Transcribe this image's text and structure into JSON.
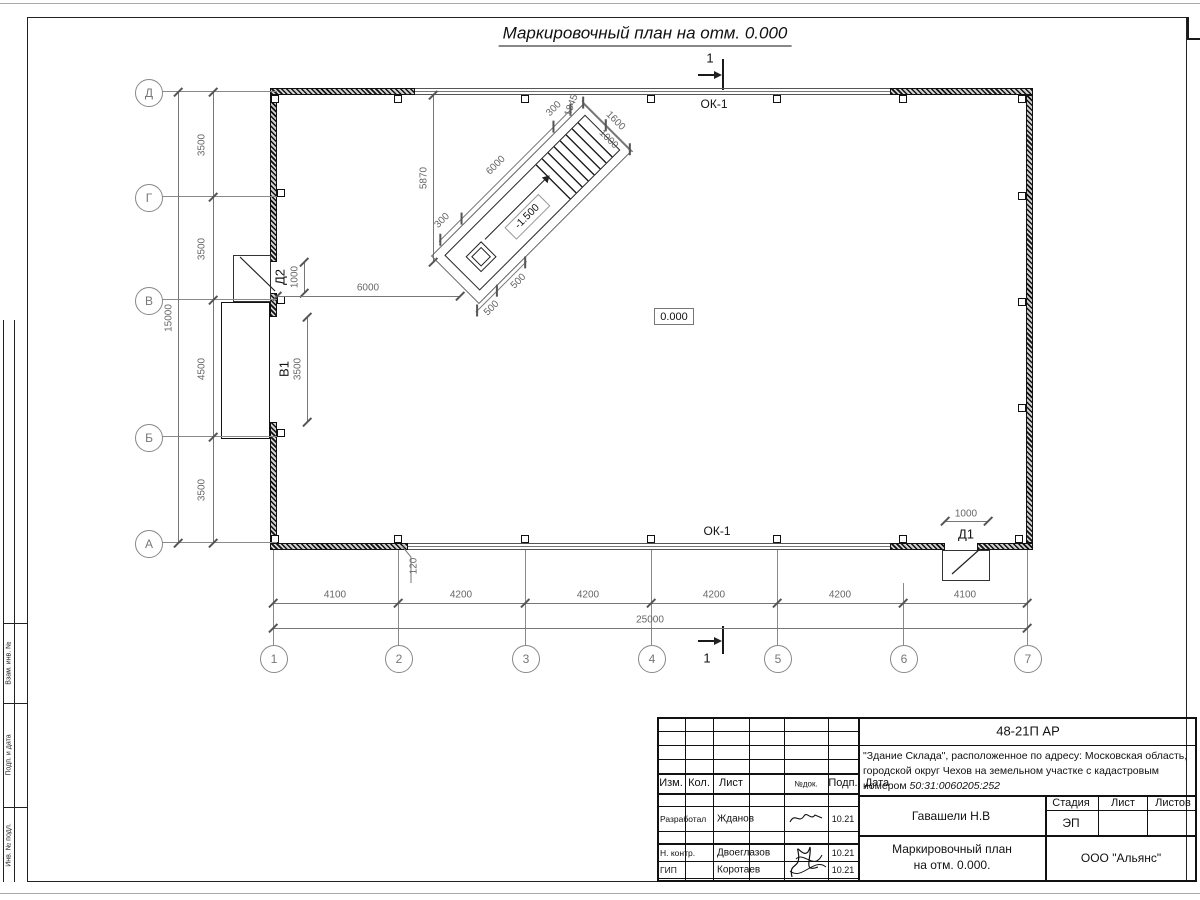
{
  "sheet": {
    "title": "Маркировочный план на отм. 0.000"
  },
  "plan": {
    "section_label_top": "1",
    "section_label_bottom": "1",
    "ok_label_top": "ОК-1",
    "ok_label_bottom": "ОК-1",
    "level_zero": "0.000",
    "row_axes": [
      "Д",
      "Г",
      "В",
      "Б",
      "А"
    ],
    "col_axes": [
      "1",
      "2",
      "3",
      "4",
      "5",
      "6",
      "7"
    ],
    "left_dims": [
      "3500",
      "3500",
      "4500",
      "3500"
    ],
    "left_total": "15000",
    "bottom_dims": [
      "4100",
      "4200",
      "4200",
      "4200",
      "4200",
      "4100"
    ],
    "bottom_total": "25000",
    "wall_offset_dim": "120",
    "stair_wall_dim": "6000",
    "stair_height_dim": "5870",
    "doors": {
      "d1": "Д1",
      "d1_dim": "1000",
      "d2": "Д2",
      "d2_dim": "1000",
      "v1": "В1",
      "v1_dim": "3500"
    },
    "stairs": {
      "level": "-1.500",
      "top_dims": [
        "300",
        "6000",
        "300"
      ],
      "end_dims": [
        "1845",
        "1000",
        "1600"
      ],
      "bottom_dims": [
        "500",
        "500"
      ]
    }
  },
  "titleblock": {
    "code": "48-21П АР",
    "desc_line1": "\"Здание Склада\", расположенное по адресу: Московская область,",
    "desc_line2": "городской округ Чехов на земельном участке с кадастровым",
    "desc_line3a": "номером ",
    "desc_line3b": "50:31:0060205:252",
    "cols": [
      "Изм.",
      "Кол.",
      "Лист",
      "№док.",
      "Подп.",
      "Дата"
    ],
    "rows": [
      {
        "role": "Разработал",
        "name": "Жданов",
        "date": "10.21"
      },
      {
        "role": "Н. контр.",
        "name": "Двоеглазов",
        "date": "10.21"
      },
      {
        "role": "ГИП",
        "name": "Коротаев",
        "date": "10.21"
      }
    ],
    "engineer": "Гавашели Н.В",
    "stage_label": "Стадия",
    "sheet_label": "Лист",
    "sheets_label": "Листов",
    "stage_value": "ЭП",
    "drawing_name_line1": "Маркировочный план",
    "drawing_name_line2": "на отм. 0.000.",
    "company": "ООО \"Альянс\""
  },
  "side_stamp": {
    "labels": [
      "Взам. инв. №",
      "Подп. и дата",
      "Инв. № подл."
    ]
  }
}
